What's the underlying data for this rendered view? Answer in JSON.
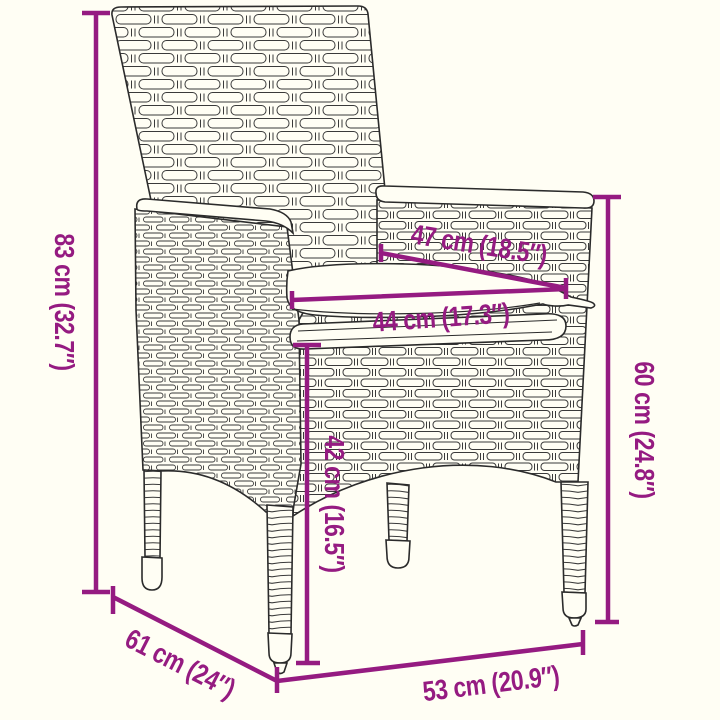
{
  "diagram": {
    "product": "poly-rattan-garden-armchair-with-seat-cushion",
    "colors": {
      "background": "#fffef4",
      "accent": "#951b81",
      "outline": "#2b2b2b"
    },
    "dimensions": [
      {
        "id": "overall-height",
        "label": "83 cm (32.7″)"
      },
      {
        "id": "backrest-width",
        "label": "47 cm (18.5″)"
      },
      {
        "id": "cushion-width",
        "label": "44 cm (17.3″)"
      },
      {
        "id": "seat-height",
        "label": "42 cm (16.5″)"
      },
      {
        "id": "armrest-height",
        "label": "60 cm (24.8″)"
      },
      {
        "id": "seat-depth",
        "label": "61 cm (24″)"
      },
      {
        "id": "seat-width",
        "label": "53 cm (20.9″)"
      }
    ]
  }
}
